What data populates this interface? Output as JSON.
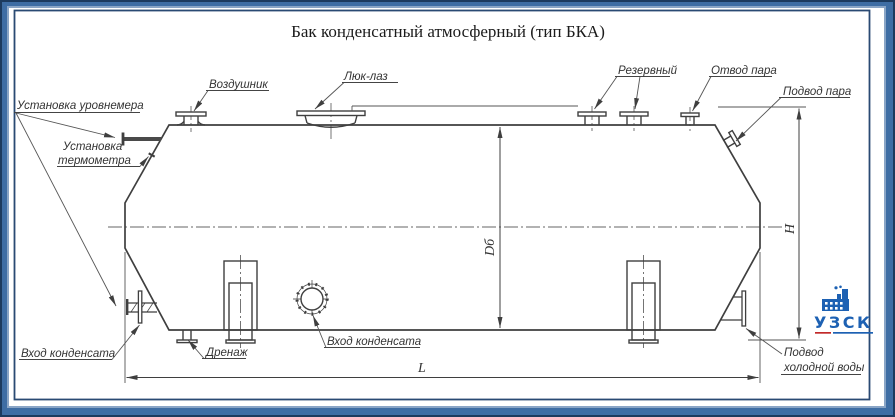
{
  "title": "Бак конденсатный атмосферный (тип БКА)",
  "labels": {
    "level_gauge": "Установка уровнемера",
    "thermometer_line1": "Установка",
    "thermometer_line2": "термометра",
    "air_vent": "Воздушник",
    "manhole": "Люк-лаз",
    "reserve": "Резервный",
    "steam_outlet": "Отвод пара",
    "steam_inlet": "Подвод пара",
    "condensate_inlet_left": "Вход конденсата",
    "drain": "Дренаж",
    "condensate_inlet_front": "Вход конденсата",
    "cold_water_line1": "Подвод",
    "cold_water_line2": "холодной воды"
  },
  "dimensions": {
    "length": "L",
    "height": "H",
    "diameter": "Dб"
  },
  "logo": {
    "name": "УЗСК"
  },
  "colors": {
    "frame_blue": "#3e6da4",
    "frame_navy": "#1c3a5e",
    "line_color": "#3f3f3f",
    "logo_blue": "#1d61b3",
    "logo_red": "#c22a2a"
  }
}
